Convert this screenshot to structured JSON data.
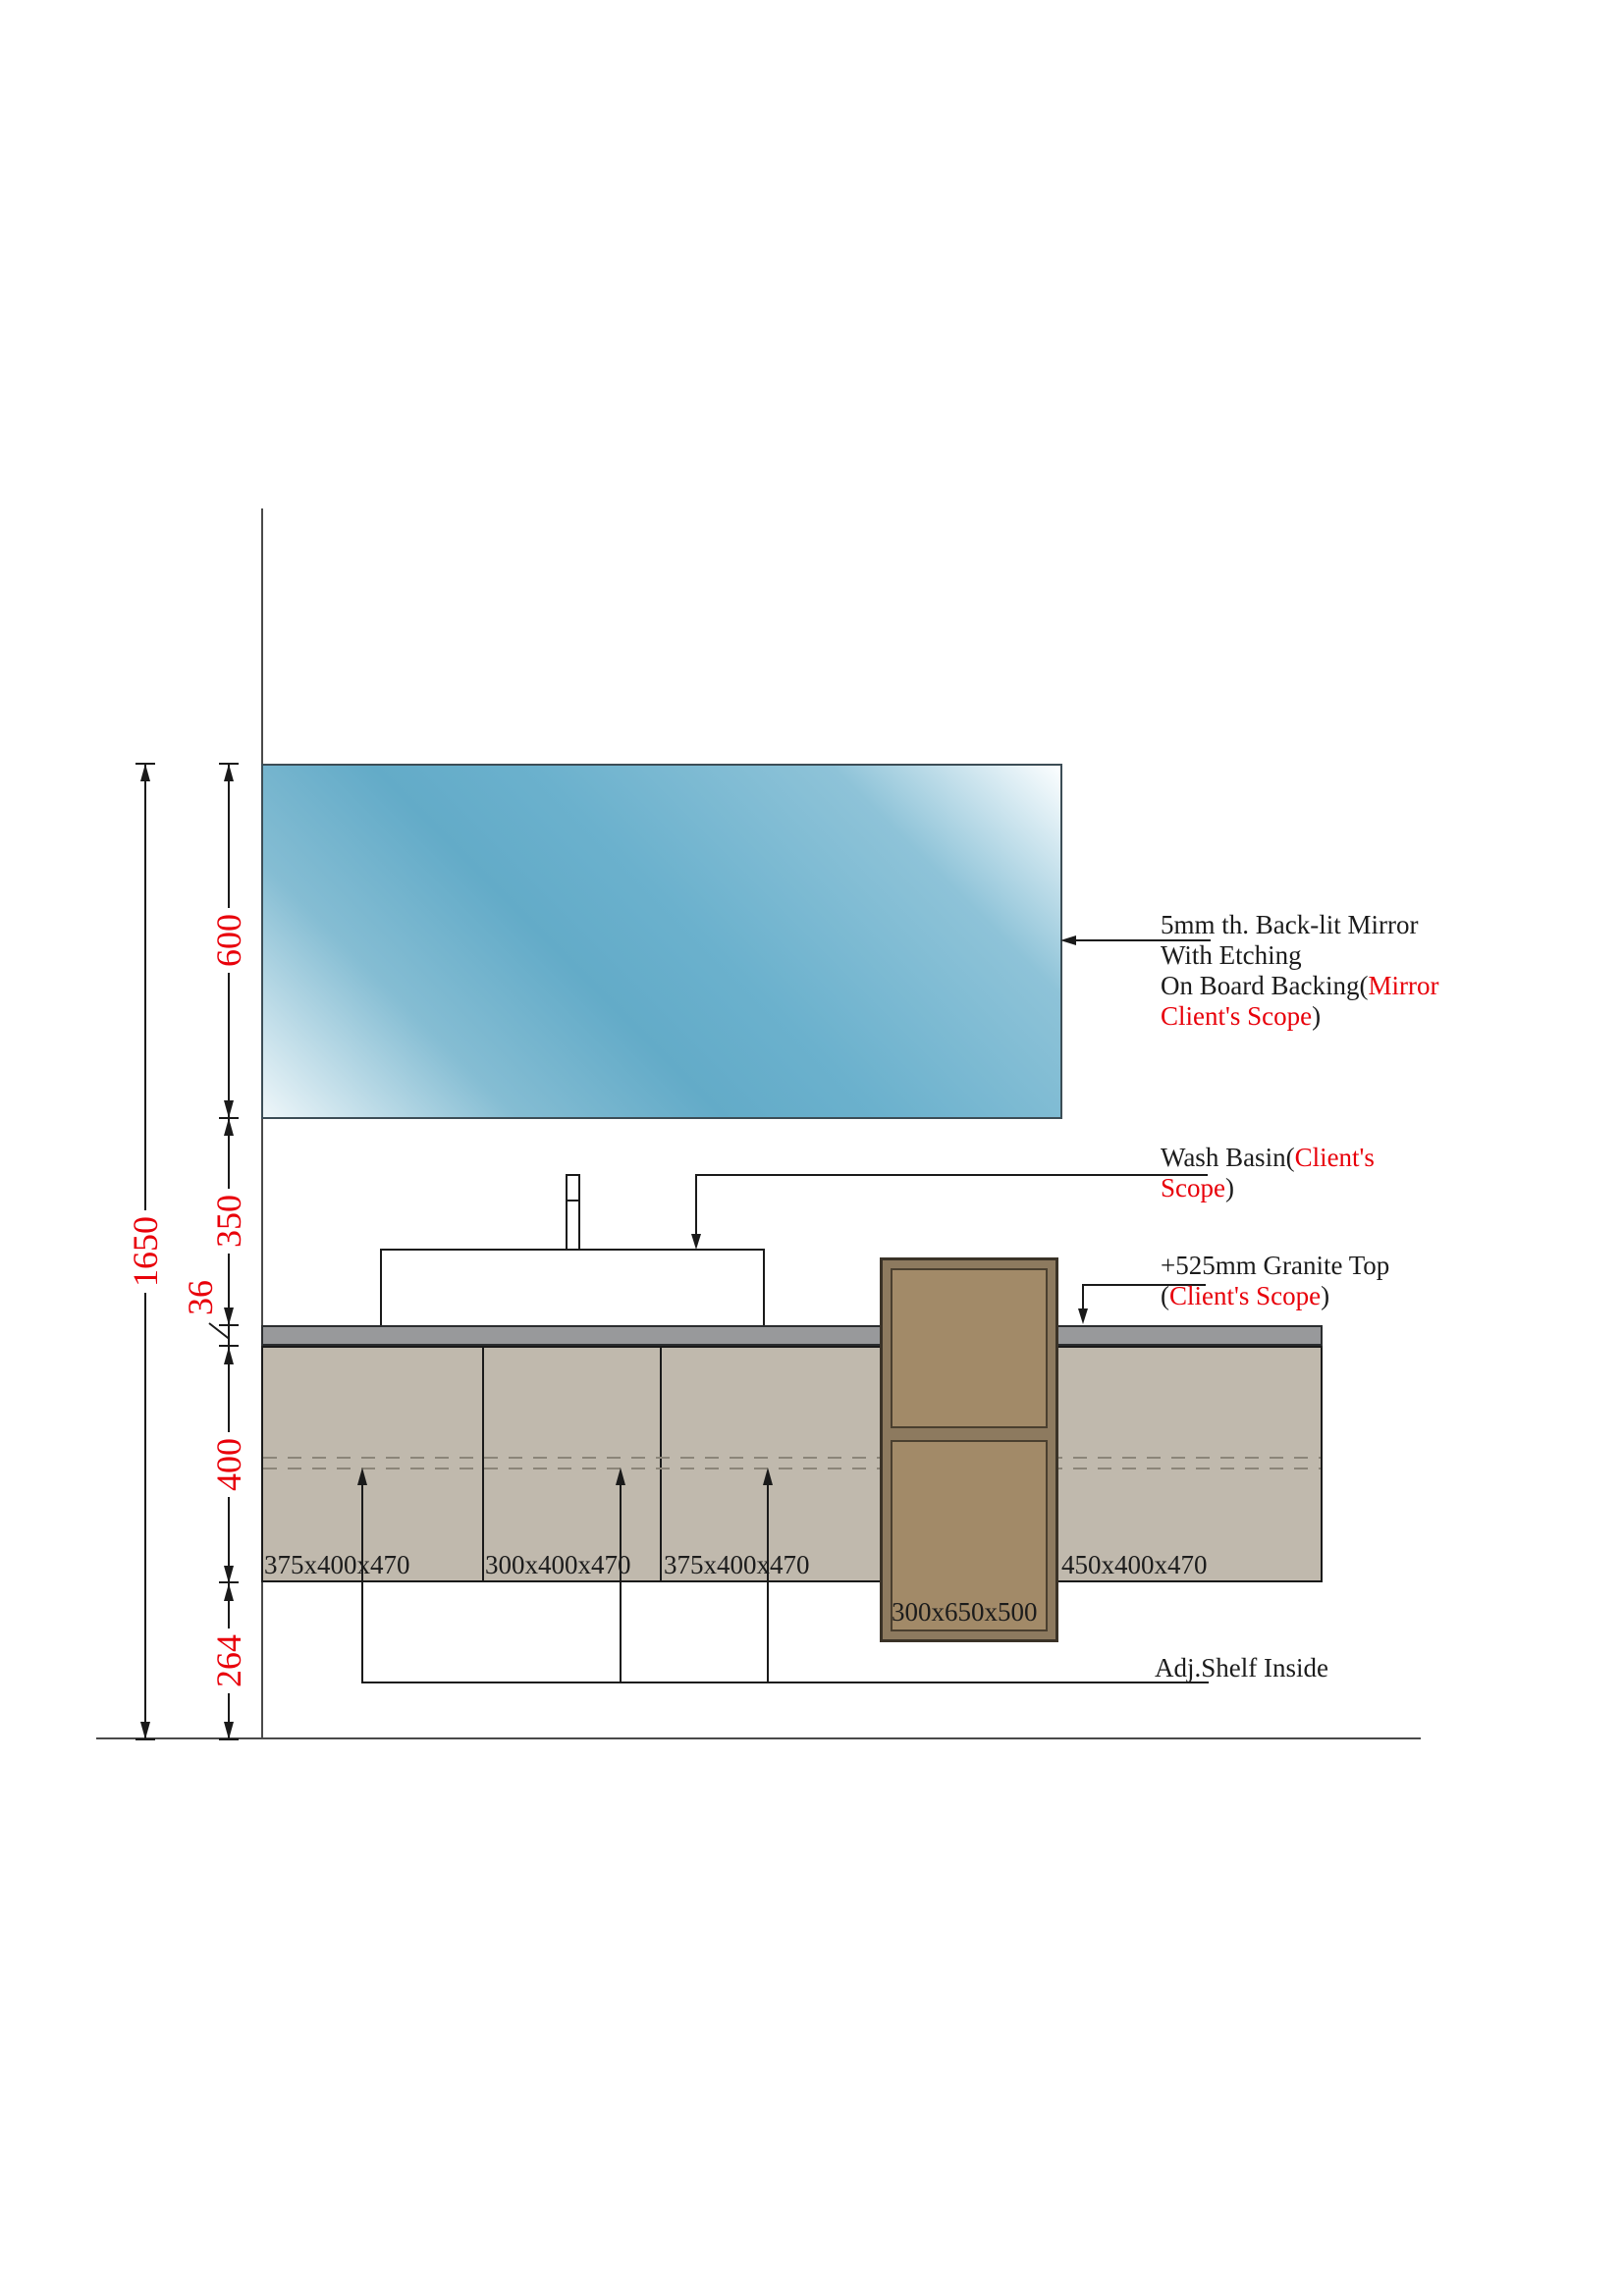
{
  "drawing": {
    "dimensions": {
      "total_height": "1650",
      "mirror_height": "600",
      "basin_zone_height": "350",
      "granite_thickness": "36",
      "cabinet_height": "400",
      "floor_clearance": "264"
    },
    "cabinet_labels": {
      "door1": "375x400x470",
      "door2": "300x400x470",
      "door3": "375x400x470",
      "door4": "450x400x470",
      "tall_unit": "300x650x500"
    },
    "notes": {
      "mirror": {
        "l1": "5mm th. Back-lit Mirror",
        "l2": "With Etching",
        "l3_black": "On Board Backing(",
        "l3_red": "Mirror",
        "l4_red": "Client's Scope",
        "l4_black": ")"
      },
      "basin": {
        "l1_black": "Wash Basin(",
        "l1_red": "Client's",
        "l2_red": "Scope",
        "l2_black": ")"
      },
      "granite": {
        "l1": "+525mm Granite Top",
        "l2_open": "(",
        "l2_red": "Client's Scope",
        "l2_close": ")"
      },
      "shelf": "Adj.Shelf Inside"
    },
    "colors": {
      "dimension_red": "#e8000a",
      "mirror_blue": "#6bb1cd",
      "granite_gray": "#98999b",
      "cabinet_tan": "#c0b9ad",
      "tall_cabinet_brown": "#8d7a5f",
      "tall_panel_brown": "#a28a68"
    }
  }
}
